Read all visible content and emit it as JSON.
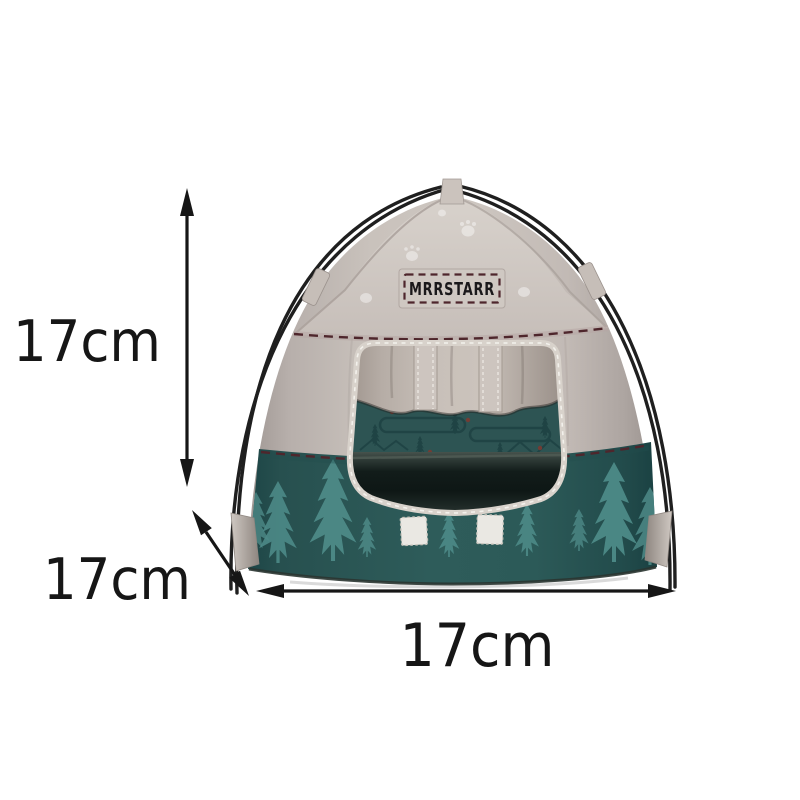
{
  "page": {
    "background_color": "#ffffff"
  },
  "product": {
    "brand_patch_text": "MRRSTARR",
    "patch": {
      "fill": "#cfc8c2",
      "stitch_color": "#4e262c",
      "text_color": "#1a181a"
    },
    "colors": {
      "canvas_beige": "#cdc6c0",
      "canvas_shadow": "#9f9793",
      "canvas_highlight": "#d8d2cc",
      "lower_panel_teal": "#2e5c5a",
      "lower_panel_dark": "#1d4546",
      "pine_tree": "#4d8a87",
      "pole": "#1f1f1f",
      "seam_stitch": "#4e262c",
      "door_trim": "#d8d2cb",
      "interior_wall": "#2d5453",
      "interior_floor_dark": "#121c1a",
      "velcro_tab": "#eae8e3"
    }
  },
  "dimension_annotations": {
    "color": "#161616",
    "height_label": "17cm",
    "depth_label": "17cm",
    "width_label": "17cm",
    "icons": {
      "height": "double-headed-vertical-arrow",
      "depth": "double-headed-diagonal-arrow",
      "width": "double-headed-horizontal-arrow"
    }
  }
}
